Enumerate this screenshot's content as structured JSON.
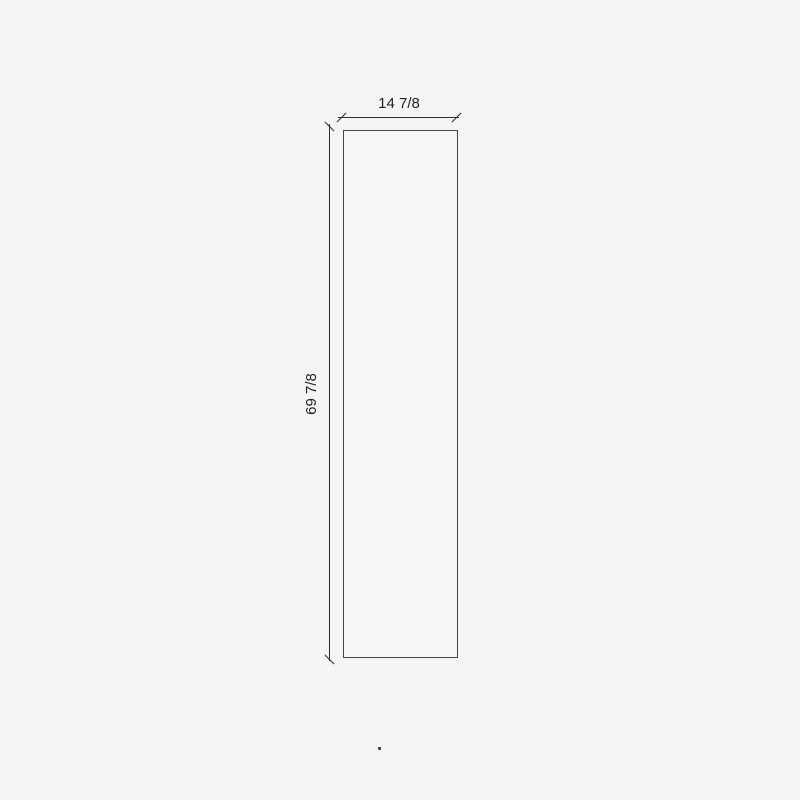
{
  "canvas": {
    "background_color": "#f5f5f5"
  },
  "drawing": {
    "rectangle": {
      "stroke_color": "#454545"
    },
    "dimension_style": {
      "line_color": "#2d2d2d",
      "text_color": "#1f1f1f"
    },
    "dimension_width": {
      "label": "14 7/8"
    },
    "dimension_height": {
      "label": "69 7/8"
    }
  }
}
